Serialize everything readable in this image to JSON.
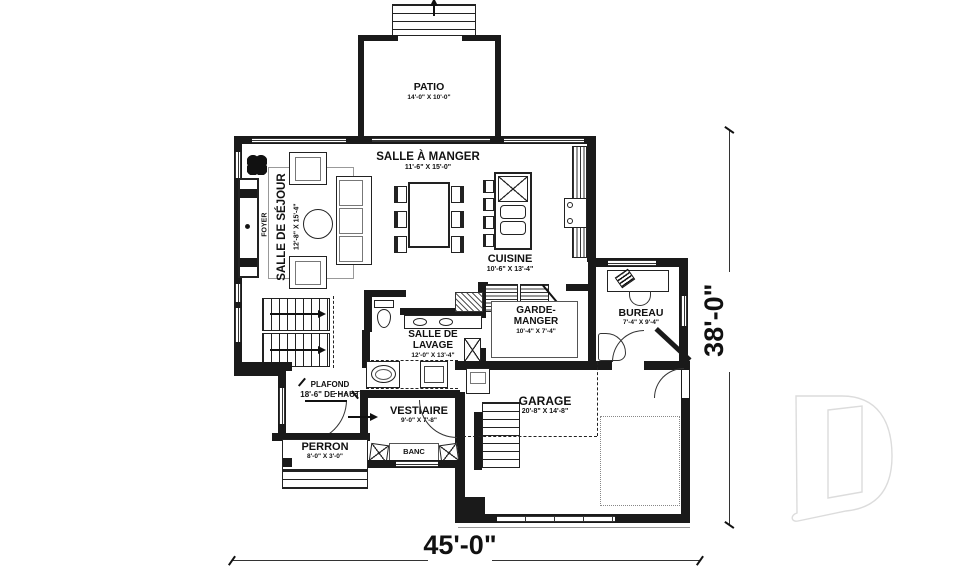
{
  "rooms": {
    "patio": {
      "name": "PATIO",
      "dims": "14'-0\" X 10'-0\""
    },
    "salle_a_manger": {
      "name": "SALLE À MANGER",
      "dims": "11'-6\" X 15'-0\""
    },
    "salle_de_sejour": {
      "name": "SALLE DE SÉJOUR",
      "dims": "12'-8\" X 15'-4\""
    },
    "cuisine": {
      "name": "CUISINE",
      "dims": "10'-6\" X 13'-4\""
    },
    "garde_manger": {
      "name1": "GARDE-",
      "name2": "MANGER",
      "dims": "10'-4\" X 7'-4\""
    },
    "bureau": {
      "name": "BUREAU",
      "dims": "7'-4\" X 9'-4\""
    },
    "salle_de_lavage": {
      "name1": "SALLE DE",
      "name2": "LAVAGE",
      "dims": "12'-0\" X 13'-4\""
    },
    "vestiaire": {
      "name": "VESTIAIRE",
      "dims": "9'-0\" X 7'-8\""
    },
    "perron": {
      "name": "PERRON",
      "dims": "8'-0\" X 3'-0\""
    },
    "garage": {
      "name": "GARAGE",
      "dims": "20'-8\" X 14'-8\""
    }
  },
  "labels": {
    "banc": "BANC",
    "foyer": "FOYER"
  },
  "notes": {
    "plafond1": "PLAFOND",
    "plafond2": "18'-6\" DE HAUT"
  },
  "dimensions": {
    "overall_width": "45'-0\"",
    "overall_height": "38'-0\""
  },
  "colors": {
    "wall": "#1a1a1a",
    "line": "#333333",
    "watermark": "#dcdcdc"
  }
}
